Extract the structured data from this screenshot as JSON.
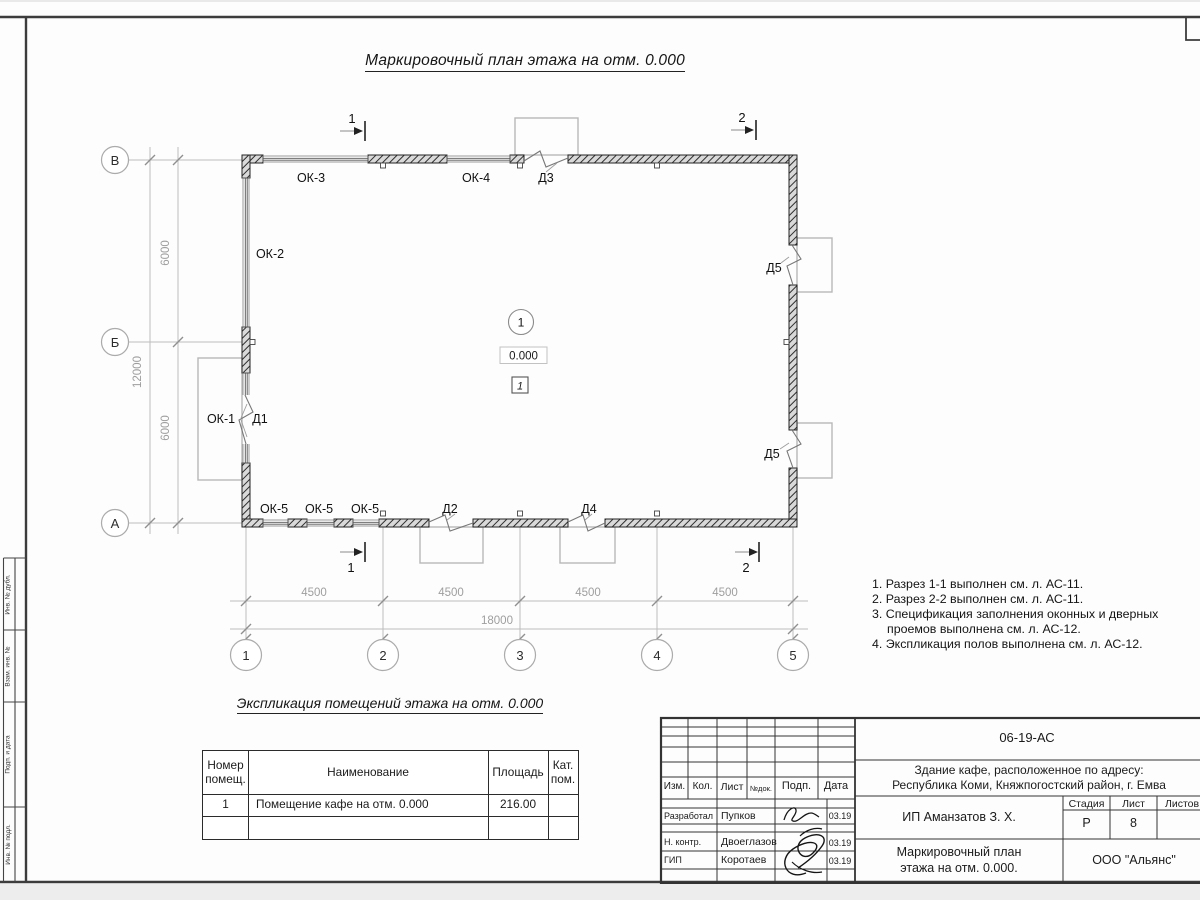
{
  "sheet": {
    "plan_title": "Маркировочный план этажа на отм. 0.000",
    "notes": [
      "1. Разрез 1-1 выполнен см. л. АС-11.",
      "2. Разрез 2-2 выполнен см. л. АС-11.",
      "3. Спецификация заполнения оконных и дверных",
      "проемов выполнена см. л. АС-12.",
      "4. Экспликация полов выполнена см. л. АС-12."
    ]
  },
  "plan": {
    "axes": {
      "rows": [
        "В",
        "Б",
        "А"
      ],
      "cols": [
        "1",
        "2",
        "3",
        "4",
        "5"
      ]
    },
    "dims": {
      "bay": "4500",
      "total_h": "18000",
      "row": "6000",
      "total_v": "12000"
    },
    "labels": {
      "ok1": "ОК-1",
      "ok2": "ОК-2",
      "ok3": "ОК-3",
      "ok4": "ОК-4",
      "ok5": "ОК-5",
      "d1": "Д1",
      "d2": "Д2",
      "d3": "Д3",
      "d4": "Д4",
      "d5": "Д5"
    },
    "sections": {
      "s1": "1",
      "s2": "2"
    },
    "room": {
      "number": "1",
      "level": "0.000",
      "floor": "1"
    }
  },
  "explication": {
    "title": "Экспликация помещений этажа на отм. 0.000",
    "headers": {
      "num1": "Номер",
      "num2": "помещ.",
      "name": "Наименование",
      "area": "Площадь",
      "cat1": "Кат.",
      "cat2": "пом."
    },
    "rows": [
      {
        "num": "1",
        "name": "Помещение кафе на отм. 0.000",
        "area": "216.00",
        "cat": ""
      }
    ]
  },
  "stamp": {
    "doc": "06-19-АС",
    "object1": "Здание кафе, расположенное по адресу:",
    "object2": "Республика Коми, Княжпогостский район, г. Емва",
    "client": "ИП Аманзатов З. Х.",
    "drawing1": "Маркировочный план",
    "drawing2": "этажа на отм. 0.000.",
    "org": "ООО \"Альянс\"",
    "cols": {
      "izm": "Изм.",
      "kol": "Кол.",
      "list": "Лист",
      "ndoc": "№док.",
      "podp": "Подп.",
      "data": "Дата"
    },
    "stage_h": "Стадия",
    "list_h": "Лист",
    "listov_h": "Листов",
    "stage": "Р",
    "list_no": "8",
    "roles": [
      {
        "role": "Разработал",
        "name": "Пупков",
        "date": "03.19"
      },
      {
        "role": "Н. контр.",
        "name": "Двоеглазов",
        "date": "03.19"
      },
      {
        "role": "ГИП",
        "name": "Коротаев",
        "date": "03.19"
      }
    ]
  },
  "side": {
    "c1": "Инв. № дубл.",
    "c2": "Взам. инв. №",
    "c3": "Подп. и дата",
    "c4": "Инв. № подл."
  }
}
